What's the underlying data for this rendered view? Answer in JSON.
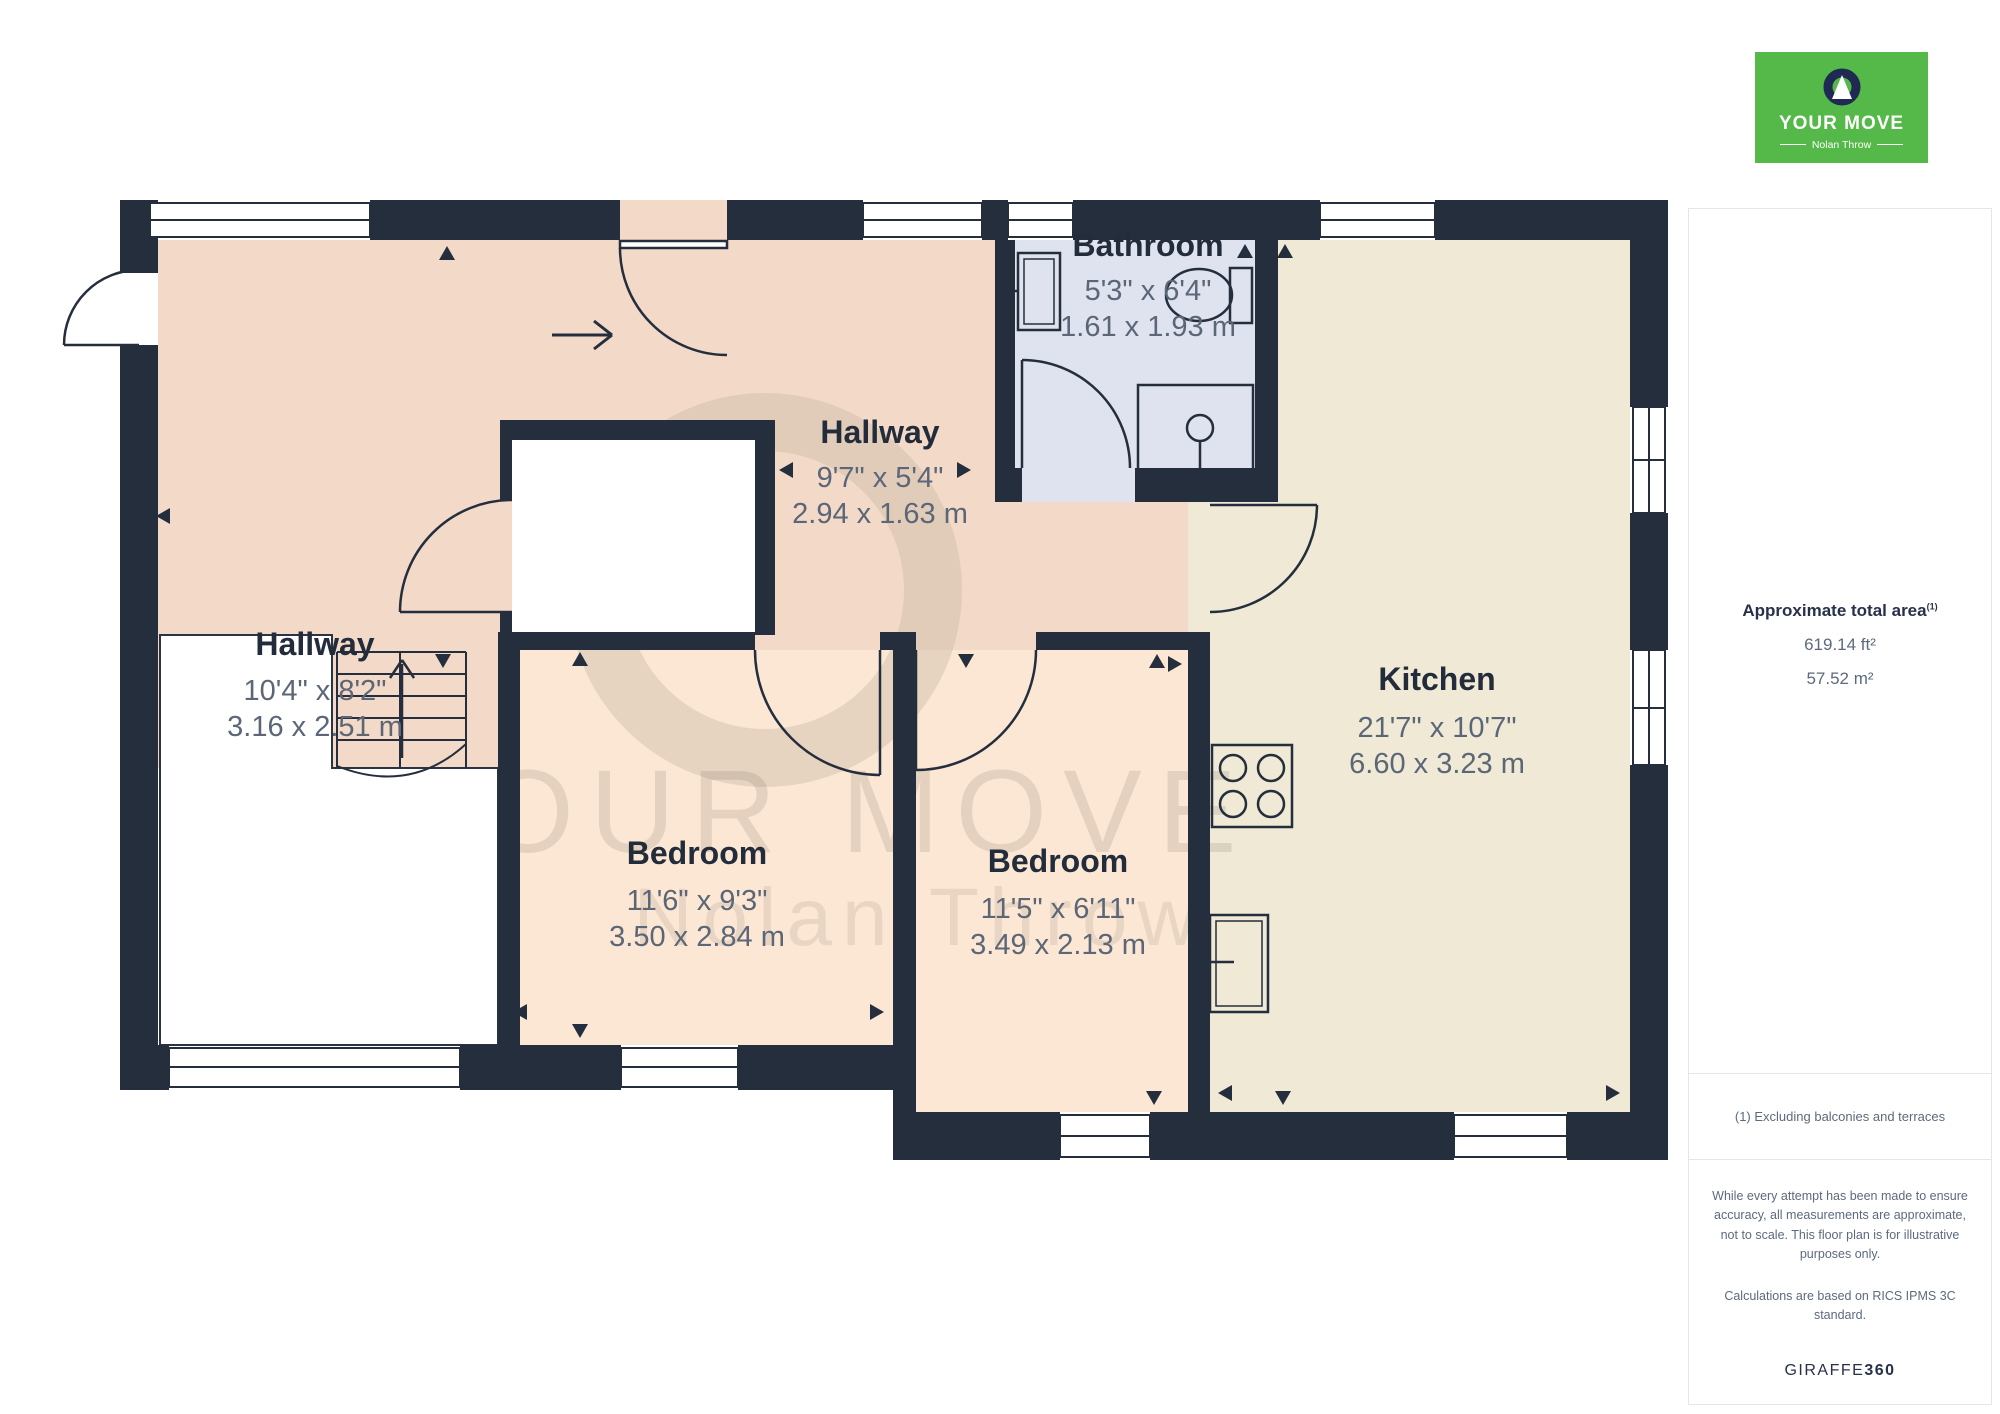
{
  "logo": {
    "brand": "YOUR MOVE",
    "sub": "Nolan Throw",
    "green": "#54b948",
    "navy": "#1e2a52"
  },
  "sidebar": {
    "total_area_label": "Approximate total area",
    "total_area_footnote_mark": "(1)",
    "area_ft": "619.14 ft²",
    "area_m": "57.52 m²",
    "footnote": "(1) Excluding balconies and terraces",
    "disclaimer1": "While every attempt has been made to ensure accuracy, all measurements are approximate, not to scale. This floor plan is for illustrative purposes only.",
    "disclaimer2": "Calculations are based on RICS IPMS 3C standard.",
    "brand_name": "GIRAFFE",
    "brand_number": "360"
  },
  "floorplan": {
    "watermark": {
      "line1": "YOUR MOVE",
      "line2": "Nolan Throw"
    },
    "rooms": [
      {
        "name": "Bathroom",
        "dim_ft": "5'3\" x 6'4\"",
        "dim_m": "1.61 x 1.93 m"
      },
      {
        "name": "Hallway",
        "dim_ft": "9'7\" x 5'4\"",
        "dim_m": "2.94 x 1.63 m"
      },
      {
        "name": "Hallway",
        "dim_ft": "10'4\" x 8'2\"",
        "dim_m": "3.16 x 2.51 m"
      },
      {
        "name": "Kitchen",
        "dim_ft": "21'7\" x 10'7\"",
        "dim_m": "6.60 x 3.23 m"
      },
      {
        "name": "Bedroom",
        "dim_ft": "11'6\" x 9'3\"",
        "dim_m": "3.50 x 2.84 m"
      },
      {
        "name": "Bedroom",
        "dim_ft": "11'5\" x 6'11\"",
        "dim_m": "3.49 x 2.13 m"
      }
    ],
    "colors": {
      "wall": "#242e3c",
      "hallway_floor": "#f3d9c8",
      "bedroom_floor": "#fbe7d4",
      "kitchen_floor": "#efe9d6",
      "bathroom_floor": "#dfe3ef",
      "label_text": "#222c3a",
      "dim_text": "#5b6677"
    }
  }
}
